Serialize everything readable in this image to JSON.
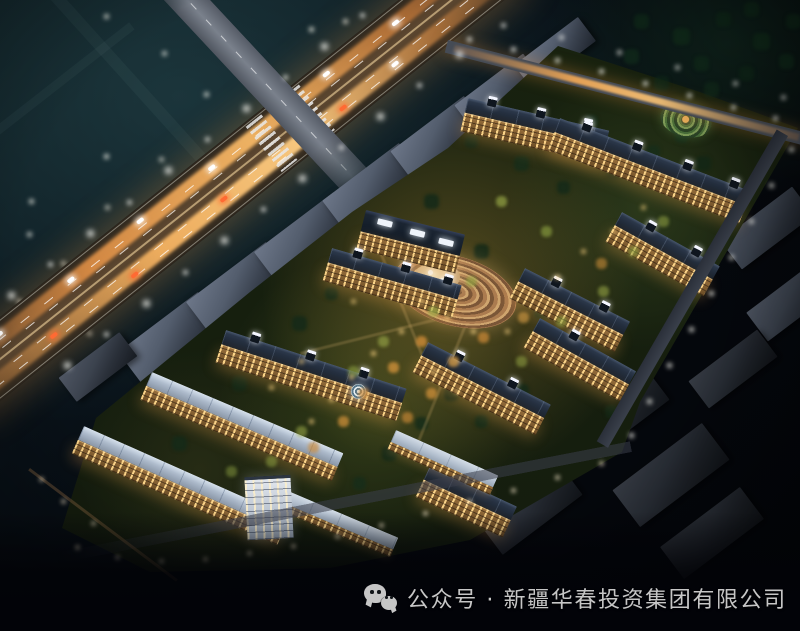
{
  "caption": {
    "icon": "wechat-icon",
    "text": "公众号 · 新疆华春投资集团有限公司"
  },
  "scene": {
    "type": "aerial-night-rendering",
    "components": [
      "highway-with-light-trails",
      "intersection-crosswalks",
      "residential-community",
      "clubhouse-plaza",
      "spiral-garden",
      "context-buildings",
      "street-lights"
    ]
  },
  "palette": {
    "caption": "#c6c6c6",
    "glow": "#f0a050",
    "teal": "#2c545a",
    "asphalt": "#4a3a27",
    "roadGray": "#7a818c",
    "slabTop": "#57606f",
    "roofDark": "#1f2834",
    "roofLight": "#c2cedd",
    "facade": "#c08c4e",
    "windows": "#ffd88c",
    "green": "#18220f",
    "lamp": "#ffffff",
    "gardenLamp": "#ffd27a"
  }
}
